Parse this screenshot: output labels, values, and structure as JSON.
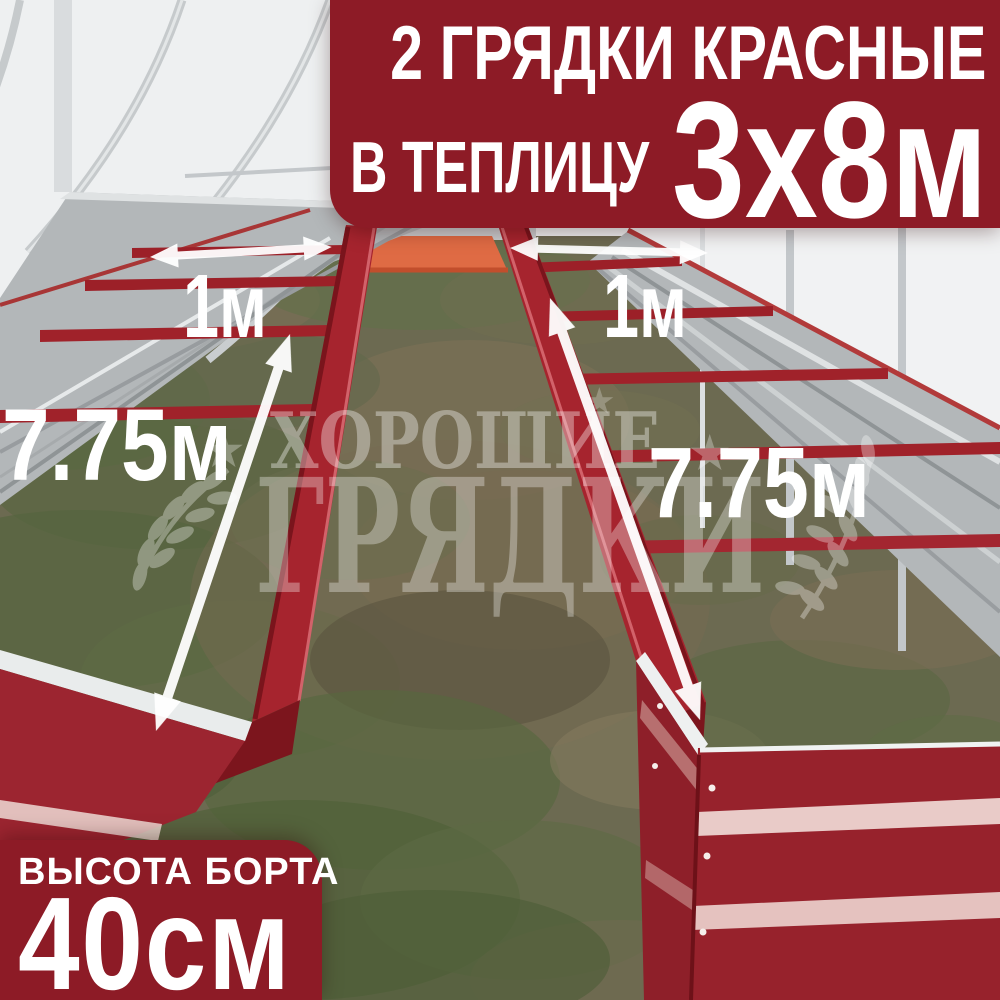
{
  "product_banner": {
    "title": "2 ГРЯДКИ КРАСНЫЕ",
    "subtitle_prefix": "В ТЕПЛИЦУ",
    "greenhouse_size": "3х8м",
    "bg_color": "#8D1B26",
    "text_color": "#FFFFFF"
  },
  "spec_banner": {
    "label": "ВЫСОТА БОРТА",
    "value": "40см",
    "bg_color": "#8D1B26"
  },
  "measurements": {
    "bed_width_left": "1м",
    "bed_width_right": "1м",
    "bed_length_left": "7.75м",
    "bed_length_right": "7.75м"
  },
  "watermark": {
    "brand_line1": "ХОРОШИЕ",
    "brand_line2": "ГРЯДКИ",
    "star": "★"
  },
  "scene": {
    "bed_color": "#A6242E",
    "bed_shadow_color": "#7C151D",
    "galvanized_color": "#B3B7B9",
    "far_end_panel_color": "#DF6B44",
    "greenhouse_wall_color": "#EEF0F1",
    "ground_color": "#6C6A51",
    "arrow_color": "#FFFFFF"
  }
}
